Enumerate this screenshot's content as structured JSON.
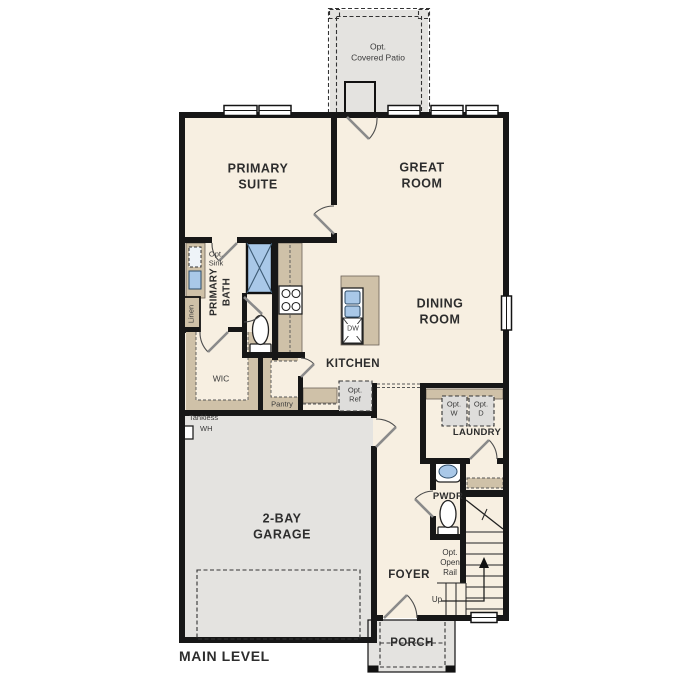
{
  "colors": {
    "floor": "#f7efe1",
    "concrete": "#e4e3e0",
    "cabinet": "#cfc1a8",
    "fixture": "#a9c8e8",
    "wall": "#171717",
    "optbox": "#dedddb",
    "text": "#2d2d2d"
  },
  "labels": {
    "patio": "Opt.\nCovered Patio",
    "primary_suite": "PRIMARY\nSUITE",
    "great_room": "GREAT\nROOM",
    "opt_sink": "Opt.\nSink",
    "linen": "Linen",
    "primary_bath": "PRIMARY\nBATH",
    "dining_room": "DINING\nROOM",
    "kitchen": "KITCHEN",
    "dw": "DW",
    "wic": "WIC",
    "pantry": "Pantry",
    "opt_ref": "Opt.\nRef",
    "opt_w": "Opt.\nW",
    "opt_d": "Opt.\nD",
    "laundry": "LAUNDRY",
    "tankless": "Tankless",
    "wh": "WH",
    "pwdr": "PWDR",
    "garage": "2-BAY\nGARAGE",
    "opt_open_rail": "Opt.\nOpen\nRail",
    "up": "Up",
    "foyer": "FOYER",
    "porch": "PORCH",
    "main_level": "MAIN LEVEL"
  }
}
